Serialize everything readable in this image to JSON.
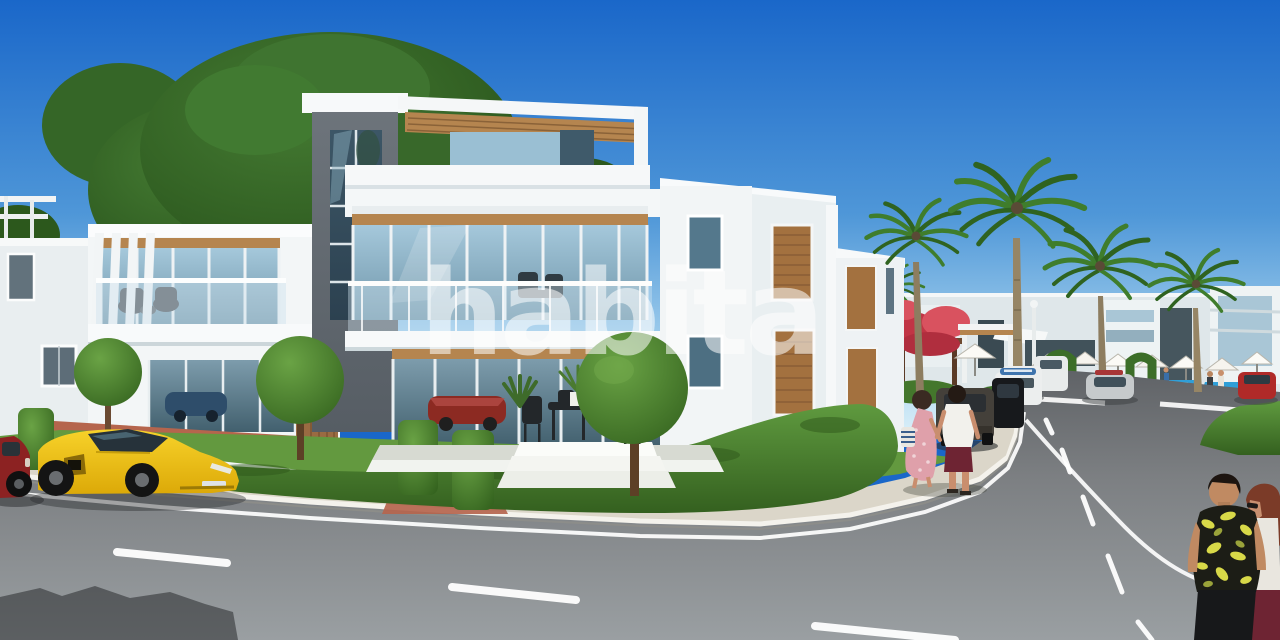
{
  "scene": {
    "watermark": {
      "text": "habita",
      "color": "#ffffff",
      "opacity": 0.55
    },
    "objects": [
      "modern-white-villa",
      "rooftop-pergola",
      "glass-balcony",
      "wooden-shutters",
      "topiary-ball-trees",
      "boxwood-hedges",
      "large-tree",
      "palm-trees",
      "yellow-sports-car",
      "red-parked-car",
      "parked-suv-row",
      "background-cars",
      "swimming-pool",
      "pool-umbrellas",
      "bougainvillea",
      "street-lamp",
      "couple-walking-away",
      "couple-foreground",
      "asphalt-road",
      "sidewalk",
      "brick-path",
      "lane-markings",
      "blue-sky"
    ]
  },
  "palette": {
    "skyTop": "#1a67c9",
    "skyMid": "#5ea2dd",
    "skyHorizon": "#d6edf8",
    "treeDark": "#2c581c",
    "treeMid": "#33631f",
    "treeLight": "#3f7430",
    "palmGreen": "#3f7d2c",
    "palmDark": "#2f6320",
    "palmTrunk": "#8d7d60",
    "wallWhite": "#f3f6f7",
    "wallShade": "#dfe7ea",
    "towerGray": "#646b72",
    "wood": "#b5854f",
    "woodDark": "#8a6238",
    "shutterWood": "#a3713f",
    "glassLight": "#a5c8db",
    "glassDark": "#4a6877",
    "hedge": "#477a2e",
    "hedgeLight": "#5f9a3f",
    "hedgeDark": "#315c1e",
    "lawn": "#63993f",
    "sidewalk": "#dbd6c9",
    "curb": "#f4f2ec",
    "brick": "#b5654d",
    "marking": "#ffffff",
    "carYellow": "#f2c413",
    "carYellowDark": "#e0ae08",
    "carRed": "#8c2222",
    "poolBlue": "#2f9fd8",
    "flowerRed": "#c13545",
    "skinTan": "#c98e6e",
    "dressPink": "#dfa0aa",
    "maroon": "#6e2433",
    "furnitureDark": "#23272a"
  }
}
